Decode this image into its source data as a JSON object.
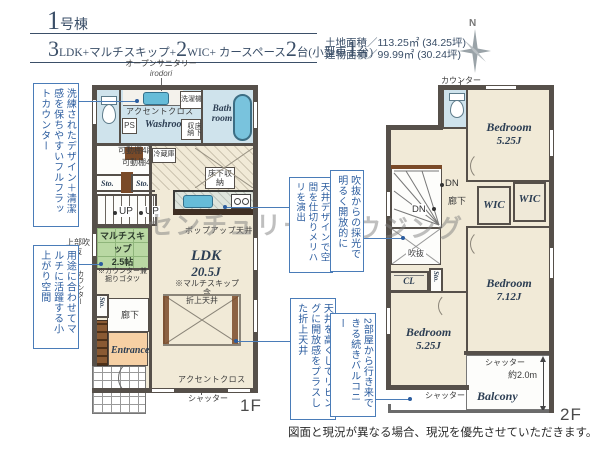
{
  "header": {
    "building_no": "1",
    "building_suffix": "号棟",
    "spec": [
      {
        "big": "3",
        "small": "LDK+マルチスキップ+"
      },
      {
        "big": "2",
        "small": "WIC+ カースペース"
      },
      {
        "big": "2",
        "small": "台(小型車"
      },
      {
        "big": "1",
        "small": "台)"
      }
    ],
    "land_area": "土地面積／113.25㎡ (34.25坪)",
    "building_area": "建物面積／99.99㎡ (30.24坪)",
    "compass_n": "N"
  },
  "annotations": {
    "left": [
      "洗練されたデザイン＋清潔感を保ちやすいフルフラットカウンター",
      "用途に合わせてマルチに活躍する小上がり空間"
    ],
    "middle": [
      "天井デザインで空間を仕切りメリハリを演出",
      "吹抜からの採光で明るく開放的に",
      "天井を高くしてリビングに開放感をプラスした折上天井",
      "2部屋から行き来できる続きバルコニー"
    ]
  },
  "floor1": {
    "floor_label": "1F",
    "labels": {
      "open_sanitary": "オープンサニタリー",
      "irodori": "irodori",
      "accent_cloth": "アクセントクロス",
      "ps": "PS",
      "washroom": "Washroom",
      "washer": "洗濯機",
      "bathroom": "Bath room",
      "underfloor": "床下収納",
      "shelf": "可動棚4段",
      "fridge": "冷蔵庫",
      "sto": "Sto.",
      "up": "UP",
      "multi_name": "マルチスキップ",
      "multi_size": "2.5帖",
      "multi_note1": "※カウンター兼",
      "multi_note2": "掘りゴタツ",
      "upper_void": "上部吹抜",
      "counter_side": "カウンター",
      "popup_ceiling": "ポップアップ天井",
      "ldk": "LDK",
      "ldk_size": "20.5J",
      "ldk_note": "※マルチスキップ含",
      "coffered_ceiling": "折上天井",
      "hallway": "廊下",
      "entrance": "Entrance",
      "shutter": "シャッター"
    }
  },
  "floor2": {
    "floor_label": "2F",
    "labels": {
      "counter_top": "カウンター",
      "bedroom": "Bedroom",
      "bedroom1_size": "5.25J",
      "bedroom2_size": "7.12J",
      "bedroom3_size": "5.25J",
      "dn": "DN",
      "hallway": "廊下",
      "wic": "WIC",
      "void": "吹抜",
      "cl": "CL",
      "sto": "Sto.",
      "shutter": "シャッター",
      "depth": "約2.0m",
      "balcony": "Balcony"
    }
  },
  "watermark": {
    "left": "センチュリー21",
    "right": "ウジング"
  },
  "footer": {
    "disclaimer": "図面と現況が異なる場合、現況を優先させていただきます。"
  }
}
